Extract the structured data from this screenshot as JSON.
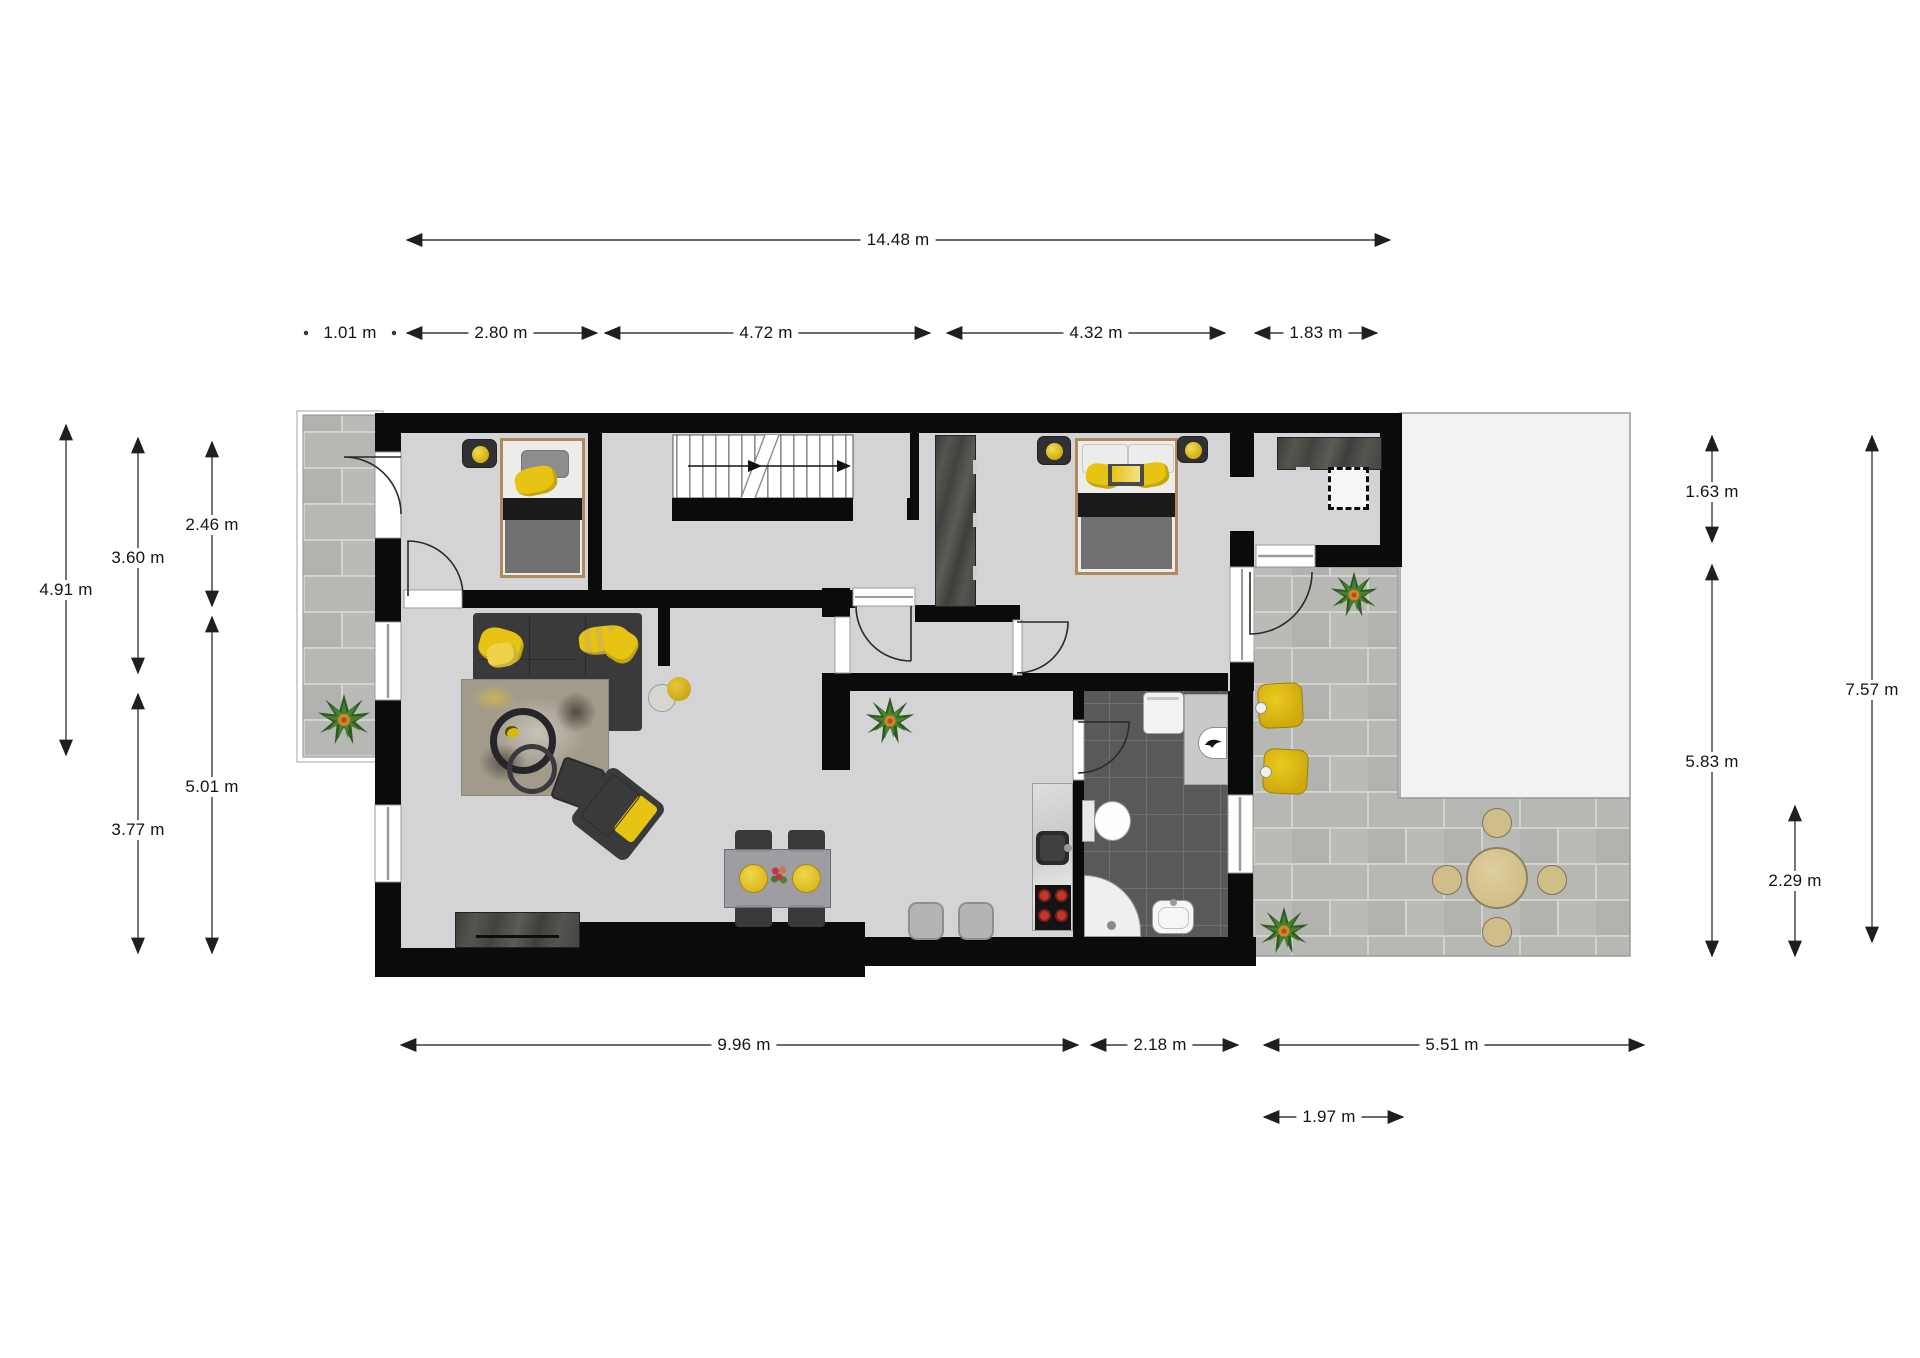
{
  "document": {
    "type": "architectural-floor-plan",
    "background": "#ffffff"
  },
  "palette": {
    "wall": "#0b0b0b",
    "floor": "#d4d4d6",
    "paving_tile": "#b7b8b4",
    "paving_grout": "#d2d2cf",
    "bathroom_tile": "#59595b",
    "roof_area": "#f1f2f1",
    "accent_yellow": "#e7c413",
    "charcoal_furniture": "#3a3a3c",
    "wood_frame": "#b08a5c",
    "dimension_text": "#141414"
  },
  "dimensions": {
    "overall_width": {
      "label": "14.48 m"
    },
    "top_segments": [
      {
        "label": "1.01 m"
      },
      {
        "label": "2.80 m"
      },
      {
        "label": "4.72 m"
      },
      {
        "label": "4.32 m"
      },
      {
        "label": "1.83 m"
      }
    ],
    "left": [
      {
        "label": "4.91 m"
      },
      {
        "label": "3.60 m"
      },
      {
        "label": "2.46 m"
      },
      {
        "label": "5.01 m"
      },
      {
        "label": "3.77 m"
      }
    ],
    "right": [
      {
        "label": "1.63 m"
      },
      {
        "label": "5.83 m"
      },
      {
        "label": "2.29 m"
      },
      {
        "label": "7.57 m"
      }
    ],
    "bottom": [
      {
        "label": "9.96 m"
      },
      {
        "label": "2.18 m"
      },
      {
        "label": "5.51 m"
      },
      {
        "label": "1.97 m"
      }
    ]
  },
  "icons": {
    "stairs_direction": "arrow-right",
    "plant": "potted-plant",
    "boiler": "boiler-logo"
  }
}
